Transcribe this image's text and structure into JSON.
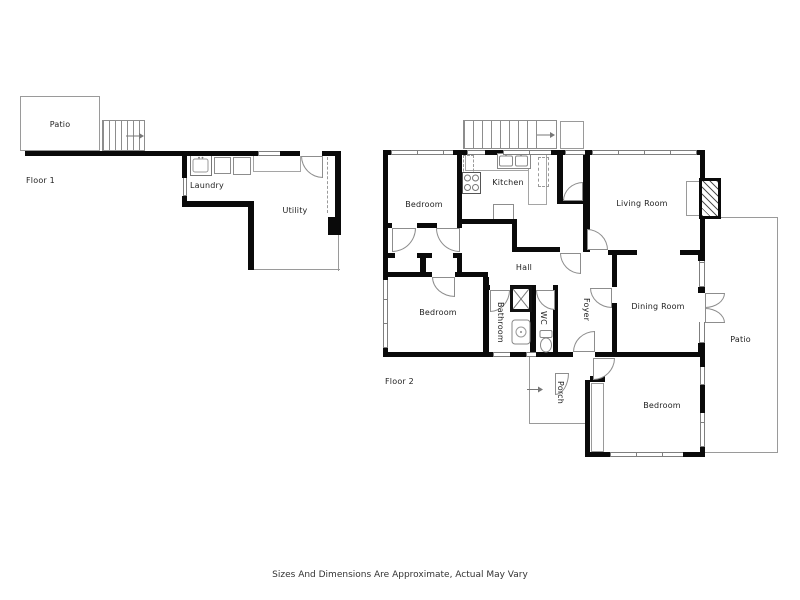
{
  "floor1": {
    "label": "Floor 1",
    "patio": "Patio",
    "laundry": "Laundry",
    "utility": "Utility"
  },
  "floor2": {
    "label": "Floor 2",
    "rooms": {
      "bedroom_top": "Bedroom",
      "kitchen": "Kitchen",
      "living_room": "Living Room",
      "hall": "Hall",
      "bedroom_mid": "Bedroom",
      "bathroom": "Bathroom",
      "wc": "WC",
      "foyer": "Foyer",
      "dining_room": "Dining Room",
      "patio": "Patio",
      "porch": "Porch",
      "bedroom_bottom": "Bedroom"
    }
  },
  "footer": {
    "disclaimer": "Sizes And Dimensions Are Approximate, Actual May Vary"
  },
  "colors": {
    "wall": "#0a0a0a",
    "thin_line": "#999999",
    "text": "#222222",
    "background": "#ffffff"
  }
}
